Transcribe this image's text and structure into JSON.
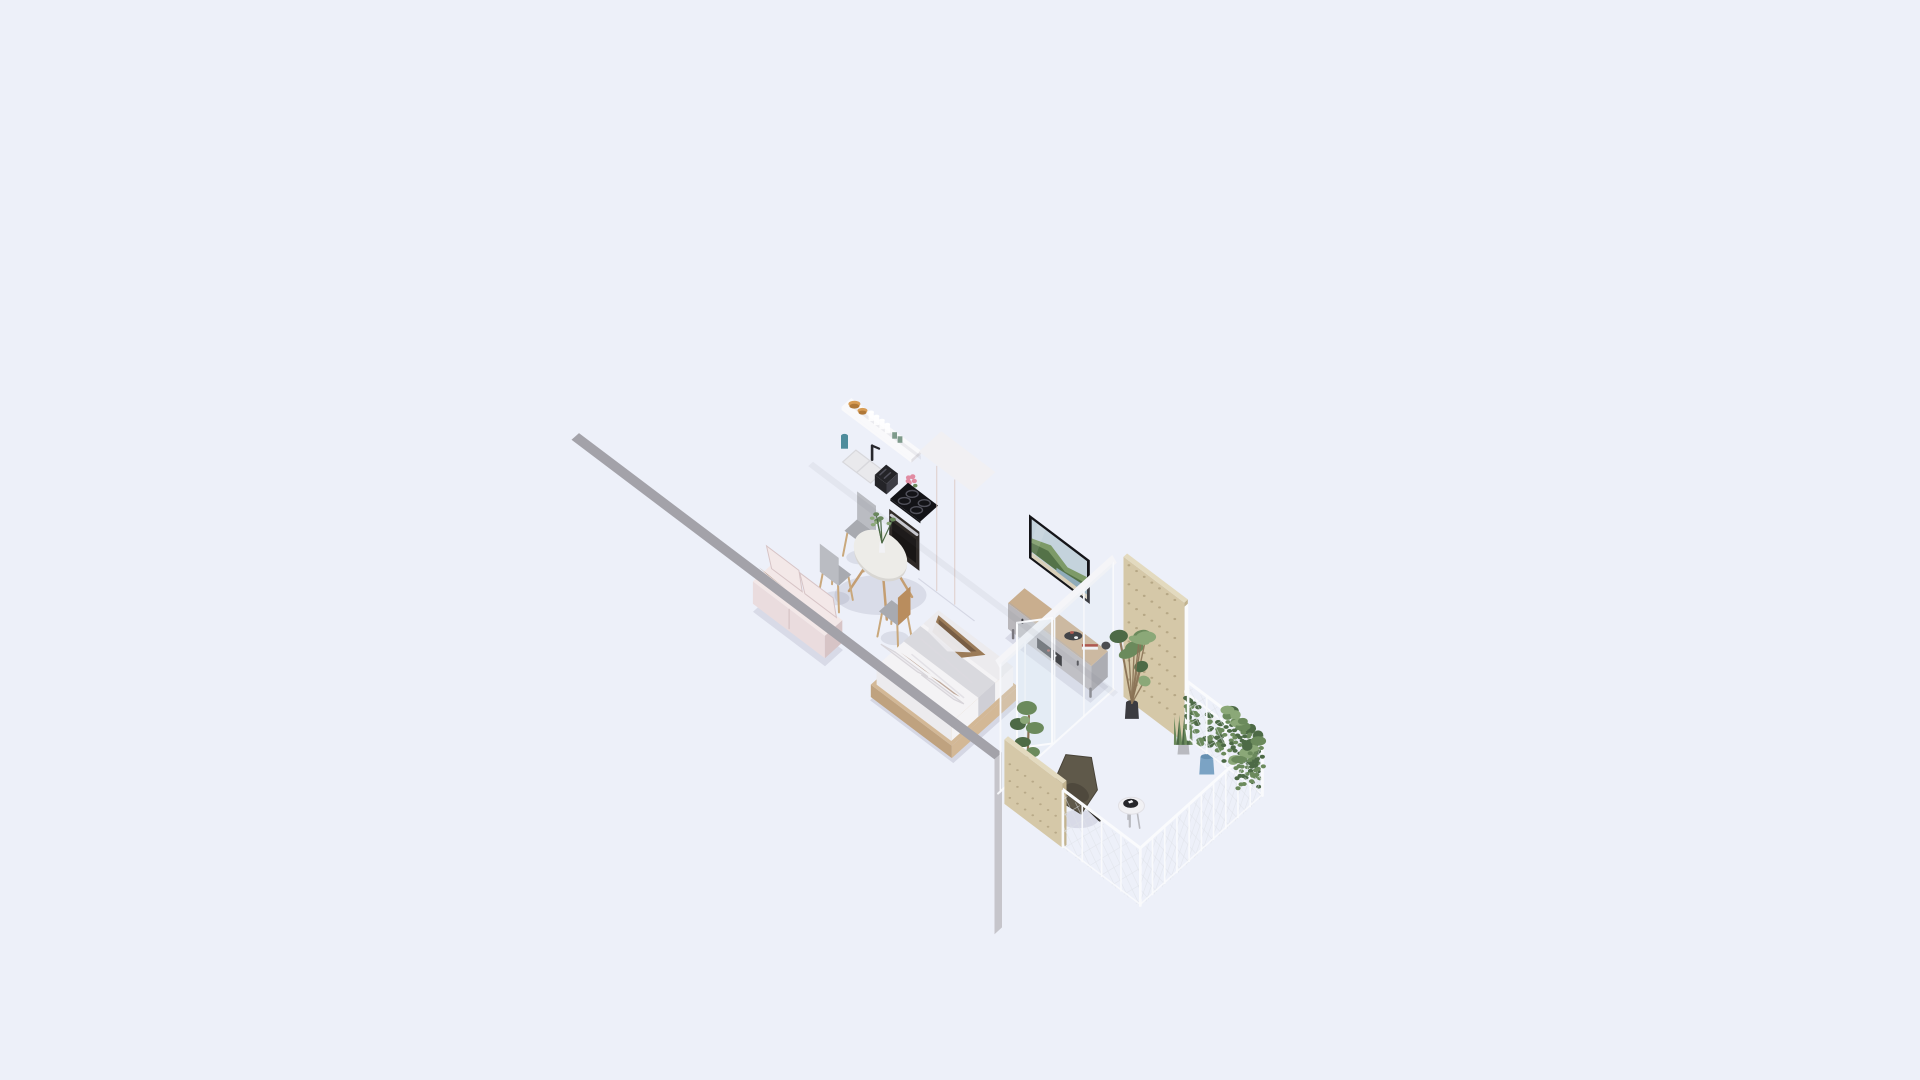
{
  "canvas": {
    "width": 1920,
    "height": 1080
  },
  "scene": {
    "type": "isometric-3d-floor-plan-render",
    "unit": "studio-apartment",
    "rooms": [
      "entry-hall",
      "bathroom",
      "kitchen",
      "living-bedroom",
      "balcony"
    ],
    "objects": [
      "entry-door",
      "bathroom-window",
      "shower",
      "toilet",
      "vanity",
      "kitchen-tall-cabinet",
      "kitchen-counter",
      "open-shelf",
      "sink",
      "toaster",
      "cooktop",
      "oven",
      "wardrobe",
      "dining-table",
      "dining-chairs",
      "table-plant",
      "sofa",
      "double-bed",
      "tv",
      "tv-console",
      "sliding-glass-door",
      "balcony-privacy-panel",
      "balcony-railing",
      "hanging-planters",
      "potted-plants",
      "lounge-chair",
      "side-table"
    ]
  },
  "colors": {
    "bg": "#edf0f9",
    "wallCap": "#a3a2a9",
    "bandNE": "#86858c",
    "bandNW": "#908f96",
    "wallEnd": "#c6c5cb",
    "intNW": "#f7f6f8",
    "intNEa": "#f2f1f5",
    "intNEb": "#e7e6eb",
    "partWhite": "#fafafc",
    "extA": "#cbcbd1",
    "extB": "#dcdce2",
    "woodA": "#e0c9b0",
    "woodB": "#e9d6c1",
    "plank": "#c8ac90",
    "hallWood": "#e6d3bd",
    "marbleF": "#e9ebee",
    "marbleW": "#f1f2f5",
    "vein": "#d5d8dd",
    "tile": "#eef0f2",
    "tileLine": "#e0e3e7",
    "slabSW": "#e9ebee",
    "slabSE": "#f4f5f7",
    "slabEdge": "#c9cacf",
    "sill": "#e9ebed",
    "doorW": "#f8f7f9",
    "doorFr": "#e3e2e7",
    "handle": "#5a585f",
    "winFr": "#eff1f5",
    "winGlass": "#dfe7f0",
    "tallF": "#c8bbaa",
    "tallS": "#a28f7c",
    "whiteBoxF": "#f4f4f6",
    "whiteBoxS": "#e3e2e7",
    "whiteBoxT": "#f7f7f9",
    "counter": "#f6f6f8",
    "counterE": "#e1e0e5",
    "kA": "#9c8471",
    "kB": "#7c6455",
    "kSide": "#6b5847",
    "kick": "#473c33",
    "splash": "#f3f3f6",
    "shelf": "#f9f9fb",
    "board": "#d6b98c",
    "basin": "#e9e9ec",
    "basinIn": "#d8d8dc",
    "faucet": "#27272c",
    "toaster": "#242428",
    "cooktop": "#131317",
    "ring": "#50505a",
    "ovenF": "#2f2a27",
    "ovenW": "#191615",
    "ovenH": "#c8c8cf",
    "amber": "#d79c55",
    "amberD": "#b07838",
    "teal": "#4e8c9c",
    "cupG": "#7e9a8b",
    "flower": "#e18ba2",
    "vaseW": "#f2f2f5",
    "leaf": "#6b8a5c",
    "leafD": "#4d6a46",
    "leafL": "#8ba878",
    "trunk": "#8a7356",
    "wardT": "#f1f0f3",
    "wardFa": "#f3eeee",
    "wardFb": "#c49e93",
    "wardSa": "#a58d7b",
    "wardSb": "#7b675a",
    "seam": "#d9c2ba",
    "tvFr": "#141418",
    "sky": "#c4d3dc",
    "hillL": "#7d9a68",
    "hillD": "#547248",
    "sea": "#90acba",
    "sand": "#d9cfb9",
    "conT": "#c9ae8e",
    "conF": "#b9b7bb",
    "conFD": "#a8a6ab",
    "conSlot": "#1d1c1f",
    "conS": "#a19fa4",
    "conLeg": "#7a787f",
    "accRed": "#a33527",
    "accWhite": "#f4f4f6",
    "accBlack": "#26262a",
    "tableT": "#edece8",
    "tableE": "#d8d6d2",
    "tableLeg": "#c49e72",
    "seat": "#a8aab0",
    "seatL": "#babcc2",
    "chLeg": "#c9a87c",
    "chWood": "#b98d5e",
    "sofaA": "#eadcde",
    "sofaB": "#f3e8e8",
    "sofaC": "#d7c4c6",
    "sofaLeg": "#a8937e",
    "platA": "#d3b896",
    "platB": "#bfa27f",
    "matt": "#f4f3f5",
    "sheet": "#ecebee",
    "runner": "#d9d9de",
    "runnerD": "#cfcfd6",
    "fold": "#dcdae0",
    "acc1": "#9b7b58",
    "acc2": "#6e5640",
    "pil": "#eceaee",
    "pilD": "#d8d5da",
    "cushT": "#b9a293",
    "ply": "#d5c8a8",
    "plyD": "#c2b38f",
    "plyDot": "#b0a17f",
    "plyT": "#e3dabf",
    "railW": "#fafbfd",
    "mesh": "#dfe2e8",
    "olive": "#5f594a",
    "oliveD": "#494439",
    "legD": "#2d2b27",
    "potB": "#7ba3c4",
    "potBD": "#6590b2",
    "potD": "#3b3b40",
    "potW": "#f1f1f4",
    "potG": "#b9bac0",
    "glassFr": "#f5f5f8"
  }
}
